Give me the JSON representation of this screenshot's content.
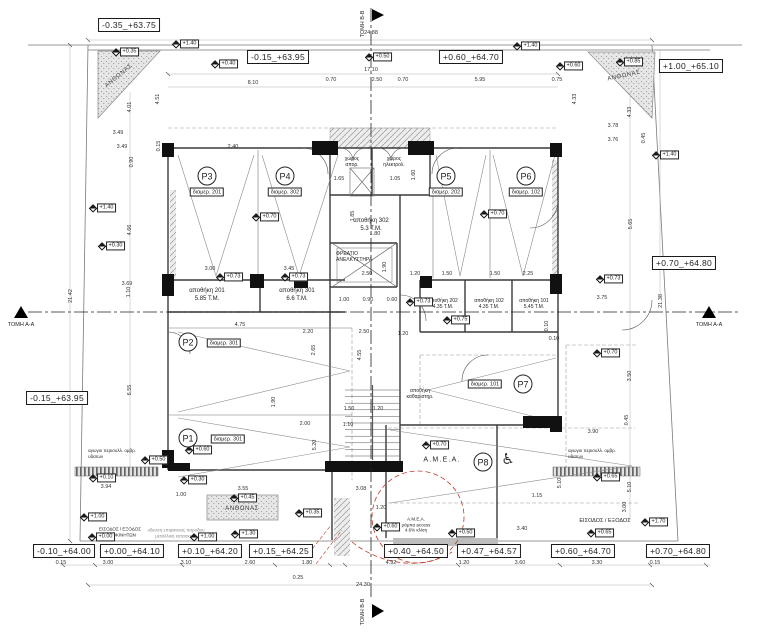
{
  "sections": {
    "aa": "ΤΟΜΗ Α-Α",
    "bb": "ΤΟΜΗ Β-Β"
  },
  "elev": [
    "-0.35_+63.75",
    "-0.15_+63.95",
    "+0.60_+64.70",
    "+1.00_+65.10",
    "+0.70_+64.80",
    "-0.15_+63.95",
    "-0.10_+64.00",
    "+0.00_+64.10",
    "+0.10_+64.20",
    "+0.15_+64.25",
    "+0.40_+64.50",
    "+0.47_+64.57",
    "+0.60_+64.70",
    "+0.70_+64.80"
  ],
  "levels": [
    "+1.40",
    "+0.40",
    "+0.50",
    "+0.60",
    "+1.40",
    "+0.85",
    "+1.40",
    "+1.40",
    "+0.35",
    "+0.70",
    "+0.70",
    "+0.73",
    "+0.73",
    "+0.73",
    "+0.73",
    "+0.75",
    "+0.30",
    "+0.70",
    "+0.70",
    "+0.60",
    "+0.50",
    "+0.10",
    "+0.30",
    "+0.45",
    "+1.00",
    "+0.00",
    "+1.00",
    "+1.30",
    "+0.35",
    "+0.60",
    "+0.50",
    "+0.65",
    "+0.65",
    "+1.70"
  ],
  "dims": [
    "24.88",
    "17.10",
    "8.10",
    "0.70",
    "2.50",
    "0.70",
    "5.95",
    "0.75",
    "4.51",
    "4.01",
    "3.49",
    "3.49",
    "0.90",
    "2.40",
    "0.15",
    "4.33",
    "4.33",
    "3.78",
    "3.76",
    "0.45",
    "4.66",
    "3.69",
    "1.10",
    "6.55",
    "5.65",
    "3.75",
    "0.10",
    "3.50",
    "3.90",
    "5.10",
    "5.10",
    "1.15",
    "3.00",
    "3.40",
    "1.65",
    "1.05",
    "1.60",
    "1.85",
    "1.80",
    "2.50",
    "1.90",
    "1.20",
    "1.50",
    "1.50",
    "2.25",
    "1.00",
    "0.90",
    "0.60",
    "3.00",
    "3.45",
    "4.75",
    "2.20",
    "2.50",
    "2.65",
    "4.55",
    "1.90",
    "2.00",
    "1.50",
    "1.20",
    "1.10",
    "5.20",
    "0.15",
    "3.00",
    "3.10",
    "2.60",
    "1.80",
    "0.25",
    "4.92",
    "1.20",
    "3.60",
    "3.30",
    "0.15",
    "24.30",
    "21.42",
    "21.38",
    "0.15",
    "0.10",
    "3.55",
    "3.94",
    "1.00",
    "3.08",
    "1.20",
    "1.20",
    "0.45"
  ],
  "parking": [
    {
      "id": "P1",
      "apt": "διαμερ. 301"
    },
    {
      "id": "P2",
      "apt": "διαμερ. 301"
    },
    {
      "id": "P3",
      "apt": "διαμερ. 201"
    },
    {
      "id": "P4",
      "apt": "διαμερ. 302"
    },
    {
      "id": "P5",
      "apt": "διαμερ. 202"
    },
    {
      "id": "P6",
      "apt": "διαμερ. 102"
    },
    {
      "id": "P7",
      "apt": "διαμερ. 101"
    },
    {
      "id": "P8"
    }
  ],
  "storage": [
    {
      "name": "αποθήκη 201",
      "area": "5.85 Τ.Μ."
    },
    {
      "name": "αποθήκη 301",
      "area": "6.6 Τ.Μ."
    },
    {
      "name": "αποθήκη 302",
      "area": "5.3 Τ.Μ."
    },
    {
      "name": "αποθήκη 202",
      "area": "4.35 Τ.Μ."
    },
    {
      "name": "αποθήκη 102",
      "area": "4.35 Τ.Μ."
    },
    {
      "name": "αποθήκη 101",
      "area": "5.45 Τ.Μ."
    },
    {
      "name": "αποθήκη",
      "area": "καθαριστηρ."
    }
  ],
  "core": {
    "lift1": "ΦΡΕΑΤΙΟ",
    "lift2": "ΑΝΕΛΚΥΣΤΗΡΑ",
    "garbage1": "χώρος",
    "garbage2": "απορ.",
    "electrical1": "χώρος",
    "electrical2": "ηλεκτρολ."
  },
  "labels": {
    "planter": "ΑΝΘΩΝΑΣ"
  },
  "drain": {
    "line1": "αγωγοι περισυλλ. ομβρ.",
    "line2": "υδατων"
  },
  "amea": {
    "label": "Α.Μ.Ε.Α.",
    "ramp1": "Α.Μ.Ε.Α.",
    "ramp2": "ράμπα access",
    "ramp3": "4.6% κλίση"
  },
  "entrances": {
    "cars1": "ΕΙΣΟΔΟΣ / ΕΞΟΔΟΣ",
    "cars2": "ΑΥΤΟΚΙΝΗΤΩΝ",
    "note1": "οδευση επιφανειας παροδου",
    "note2": "μεταλλικη κατασκευη",
    "pedestrian": "ΕΙΣΟΔΟΣ / ΕΞΟΔΟΣ"
  },
  "icons": {
    "wheelchair": "♿"
  },
  "colors": {
    "red": "#c0392b",
    "ink": "#333333",
    "hatch": "#8f8f8f"
  }
}
